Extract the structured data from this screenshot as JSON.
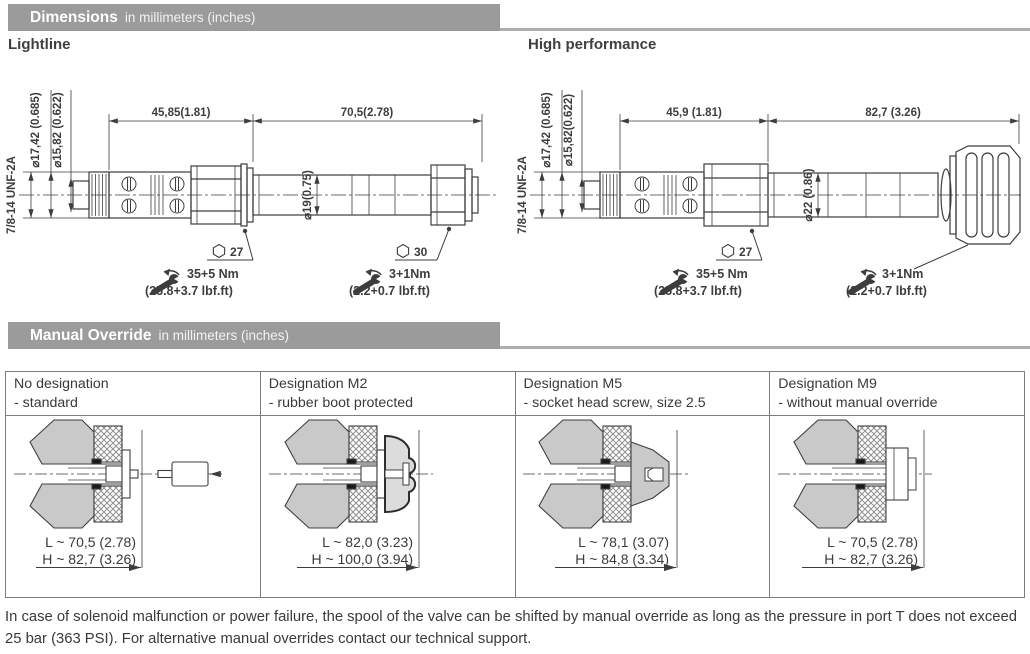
{
  "colors": {
    "section_bar": "#9b9b9b",
    "section_line": "#adadad",
    "drawing_stroke": "#3d3d3d",
    "nut_fill": "#c9c9c9",
    "text": "#3a3a3a"
  },
  "sections": {
    "dimensions": {
      "title": "Dimensions",
      "subtitle": "in millimeters (inches)"
    },
    "manual_override": {
      "title": "Manual Override",
      "subtitle": "in millimeters (inches)"
    }
  },
  "lightline": {
    "label": "Lightline",
    "thread": "7/8-14 UNF-2A",
    "dia_outer": "⌀17,42 (0.685)",
    "dia_inner": "⌀15,82 (0.622)",
    "length_front": "45,85(1.81)",
    "length_rear": "70,5(2.78)",
    "dia_tube": "⌀19(0.75)",
    "hex_front": "27",
    "hex_rear": "30",
    "torque_front_nm": "35+5 Nm",
    "torque_front_lbf": "(25.8+3.7 lbf.ft)",
    "torque_rear_nm": "3+1Nm",
    "torque_rear_lbf": "(2.2+0.7 lbf.ft)"
  },
  "high_performance": {
    "label": "High performance",
    "thread": "7/8-14 UNF-2A",
    "dia_outer": "⌀17,42 (0.685)",
    "dia_inner": "⌀15,82(0.622)",
    "length_front": "45,9 (1.81)",
    "length_rear": "82,7 (3.26)",
    "dia_tube": "⌀22 (0.86)",
    "hex_front": "27",
    "torque_front_nm": "35+5 Nm",
    "torque_front_lbf": "(25.8+3.7 lbf.ft)",
    "torque_rear_nm": "3+1Nm",
    "torque_rear_lbf": "(2.2+0.7 lbf.ft)"
  },
  "override_table": {
    "columns": [
      {
        "title": "No designation",
        "subtitle": "- standard",
        "dim_l": "L ~ 70,5 (2.78)",
        "dim_h": "H ~ 82,7 (3.26)"
      },
      {
        "title": "Designation M2",
        "subtitle": "- rubber boot protected",
        "dim_l": "L ~ 82,0 (3.23)",
        "dim_h": "H ~ 100,0 (3.94)"
      },
      {
        "title": "Designation M5",
        "subtitle": "- socket head screw, size 2.5",
        "dim_l": "L ~ 78,1 (3.07)",
        "dim_h": "H ~ 84,8 (3.34)"
      },
      {
        "title": "Designation M9",
        "subtitle": "- without manual override",
        "dim_l": "L ~ 70,5 (2.78)",
        "dim_h": "H ~ 82,7 (3.26)"
      }
    ]
  },
  "footer": "In case of solenoid malfunction or power failure, the spool of the valve can be shifted by manual override as long as the pressure in port T does not exceed 25 bar (363 PSI). For alternative manual overrides contact our technical support."
}
